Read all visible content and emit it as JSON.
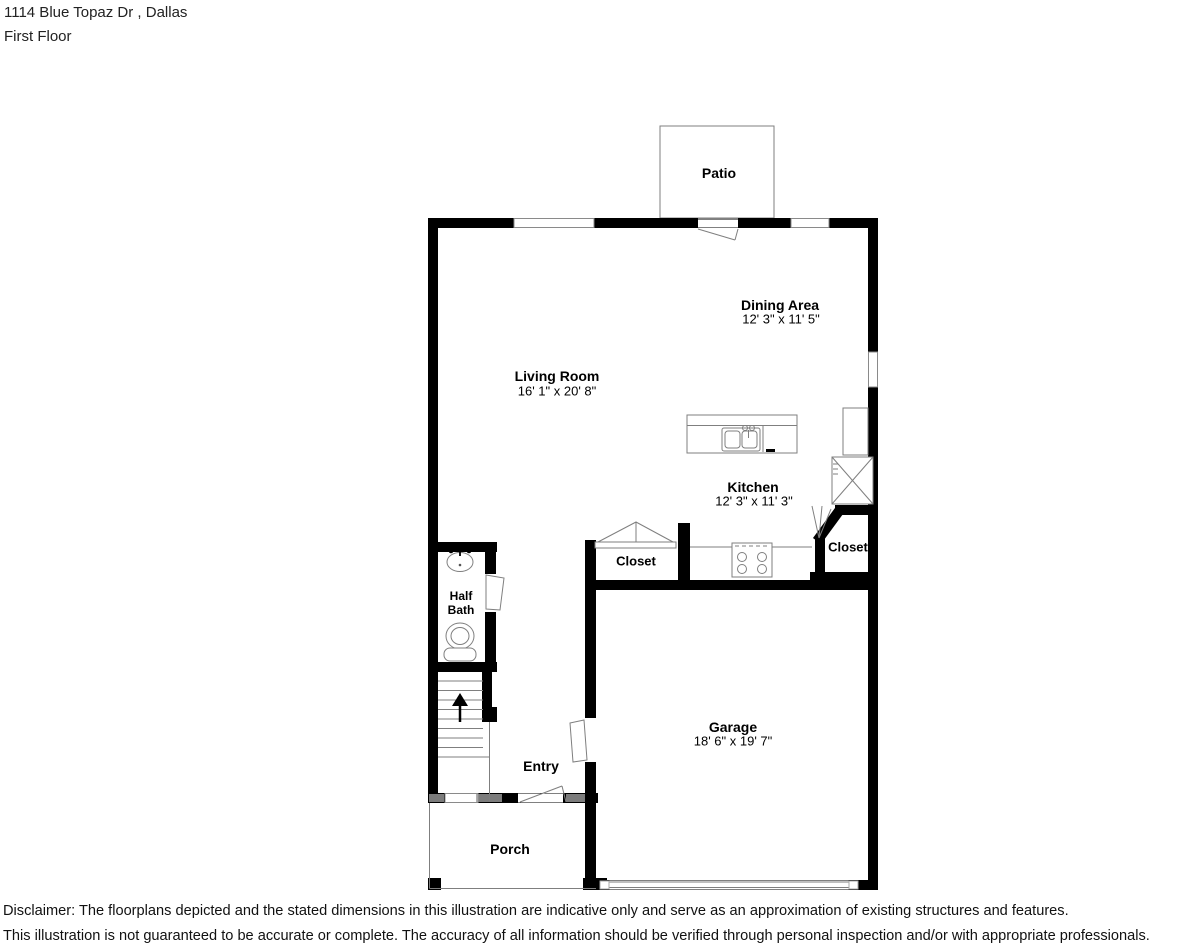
{
  "header": {
    "address_line": "1114 Blue Topaz Dr , Dallas",
    "floor_line": "First Floor"
  },
  "rooms": {
    "patio": {
      "label": "Patio"
    },
    "dining": {
      "label": "Dining Area",
      "dims": "12' 3\" x 11' 5\""
    },
    "living": {
      "label": "Living Room",
      "dims": "16' 1\" x 20' 8\""
    },
    "kitchen": {
      "label": "Kitchen",
      "dims": "12' 3\" x 11' 3\""
    },
    "kitchen_closet": {
      "label": "Closet"
    },
    "right_closet": {
      "label": "Closet"
    },
    "half_bath": {
      "label": "Half Bath"
    },
    "entry": {
      "label": "Entry"
    },
    "garage": {
      "label": "Garage",
      "dims": "18' 6\" x 19' 7\""
    },
    "porch": {
      "label": "Porch"
    }
  },
  "disclaimer": {
    "line1": "Disclaimer: The floorplans depicted and the stated dimensions in this illustration are indicative only and serve as an approximation of existing structures and features.",
    "line2": "This illustration is not guaranteed to be accurate or complete. The accuracy of all information should be verified through personal inspection and/or with appropriate professionals."
  },
  "colors": {
    "background": "#ffffff",
    "wall": "#000000",
    "thin_line": "#7f7f7f",
    "text": "#000000"
  }
}
